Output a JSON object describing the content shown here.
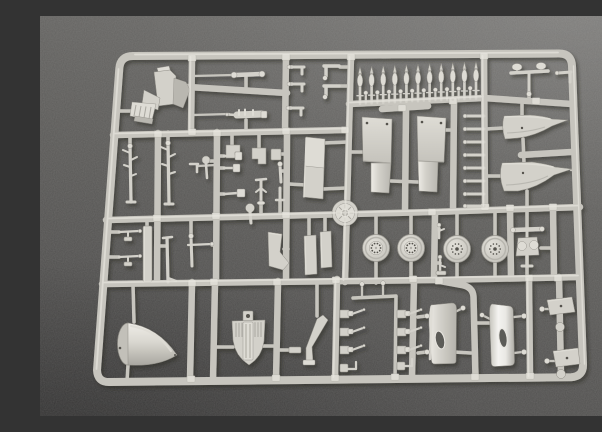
{
  "scene": {
    "type": "photograph",
    "subject": "Light gray injection-molded model kit sprue (parts tree) photographed on dark gray textured felt",
    "sprue_material": "light gray styrene plastic",
    "background_surface": "dark gray felt"
  },
  "colors": {
    "bg_light": "#72716f",
    "bg_mid": "#5c5b59",
    "bg_dark": "#464545",
    "plastic": "#c7c5be",
    "plastic_hl": "#e9e7e0",
    "plastic_sh": "#8e8c85",
    "part": "#d3d1ca",
    "part_light": "#dedcd5",
    "hole": "#54524d"
  },
  "parts_inventory": [
    {
      "name": "pilot-seat",
      "count": 1
    },
    {
      "name": "bomb-row-top",
      "count": 11
    },
    {
      "name": "engine-nacelle-halves",
      "count": 2
    },
    {
      "name": "cowl-fairings-right",
      "count": 2
    },
    {
      "name": "main-wheels",
      "count": 4
    },
    {
      "name": "ribbed-disc",
      "count": 1
    },
    {
      "name": "rectangular-panel",
      "count": 1
    },
    {
      "name": "landing-gear-struts",
      "count": 5
    },
    {
      "name": "machine-gun",
      "count": 1
    },
    {
      "name": "nose-cone-spinner",
      "count": 1
    },
    {
      "name": "ribbed-bulkhead",
      "count": 1
    },
    {
      "name": "bent-strut",
      "count": 1
    },
    {
      "name": "small-gun-columns",
      "count": 8
    },
    {
      "name": "glossy-side-panels",
      "count": 2
    },
    {
      "name": "trapezoid-flaps",
      "count": 2
    },
    {
      "name": "ladder-rungs",
      "count": 8
    },
    {
      "name": "axle-with-caps",
      "count": 1
    }
  ]
}
